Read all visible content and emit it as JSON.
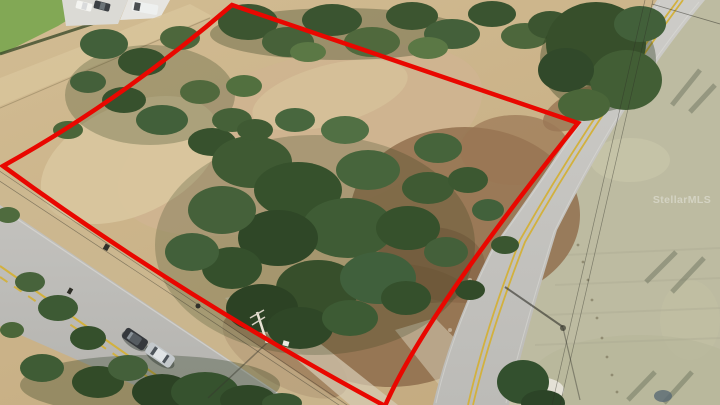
{
  "scene": {
    "description": "Aerial drone photo of a wooded vacant land parcel outlined in red, bordered by two rural two-lane roads",
    "watermark": {
      "text": "StellarMLS",
      "color": "#f5f5f2"
    },
    "boundary": {
      "color": "#e90700",
      "stroke_width": 4.5,
      "path": "M 232,5 L 578,123 Q 424,316 385,406 Q 178,294 3,166 Q 122,100 232,5 Z"
    },
    "palette": {
      "dirt_tan": "#c8b086",
      "dry_grass_field": "#bdbba1",
      "lawn_green": "#82a855",
      "tree_dark_green": "#35502c",
      "tree_mid_green": "#46613a",
      "scrub_brown": "#92704f",
      "road_asphalt": "#c2c1bd",
      "lane_marking_yellow": "#d2b13e",
      "gravel_white": "#e9e6dd"
    },
    "vehicles": {
      "parked_sedan_dark": "#35383c",
      "parked_sedan_silver": "#c3c8cb",
      "truck_white": "#f4f4f1",
      "truck_dark": "#3c4044",
      "rv_white": "#eef0ef"
    }
  }
}
